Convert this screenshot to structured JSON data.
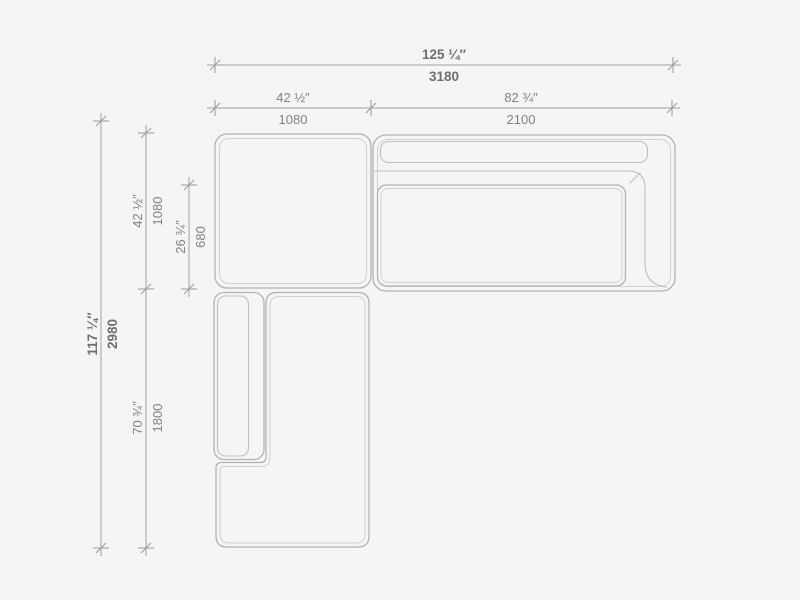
{
  "colors": {
    "background": "#f5f5f5",
    "furniture_outline": "#b2b2b2",
    "furniture_inner_line": "#d0d0d0",
    "dimension_line": "#9e9e9e",
    "dimension_text": "#828282",
    "dimension_text_primary": "#6f6f6f"
  },
  "dims": {
    "overall_width": {
      "inches": "125 ¼″",
      "mm": "3180"
    },
    "left_module_width": {
      "inches": "42 ½″",
      "mm": "1080"
    },
    "right_module_width": {
      "inches": "82 ¾″",
      "mm": "2100"
    },
    "overall_depth": {
      "inches": "117 ¼″",
      "mm": "2980"
    },
    "left_module_depth": {
      "inches": "42 ½″",
      "mm": "1080"
    },
    "seat_depth": {
      "inches": "26 ¾″",
      "mm": "680"
    },
    "chaise_depth": {
      "inches": "70 ¾″",
      "mm": "1800"
    }
  }
}
